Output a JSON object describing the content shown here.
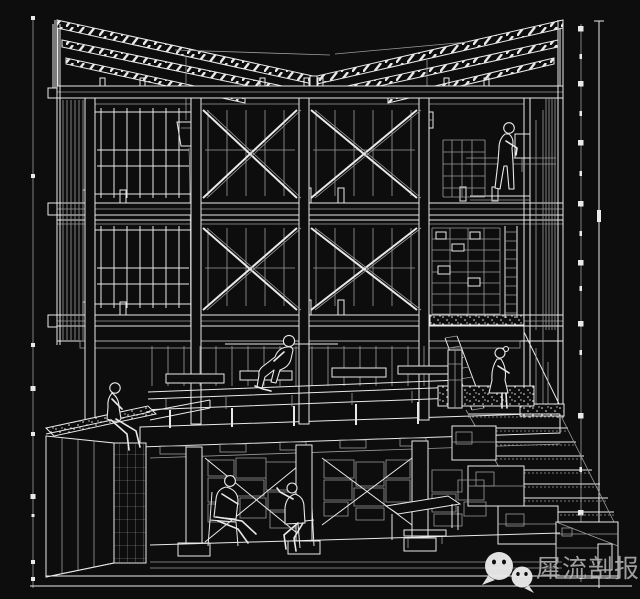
{
  "watermark": {
    "label": "犀流剖报",
    "icon": "wechat-icon"
  },
  "palette": {
    "background": "#0d0d0d",
    "line_bright": "#e9e9e9",
    "line_dim": "#9b9b9b",
    "watermark_text": "#b4b4b4"
  },
  "drawing": {
    "type": "architectural-section-perspective",
    "style": "white-wireframe-on-black",
    "levels": [
      "butterfly-roof",
      "third-floor",
      "second-floor",
      "first-floor-platform",
      "basement"
    ],
    "figures": [
      "standing-man-upper-floor",
      "seated-woman-center-platform",
      "seated-woman-planter-edge",
      "standing-woman-stair-landing",
      "seated-man-basement-left",
      "seated-man-basement-right"
    ],
    "elements": [
      "left-dimension-line",
      "right-dimension-line",
      "x-bracing",
      "window-mullions",
      "hanging-planter",
      "ladders",
      "exterior-stair",
      "gravel-planter",
      "basement-columns"
    ]
  }
}
